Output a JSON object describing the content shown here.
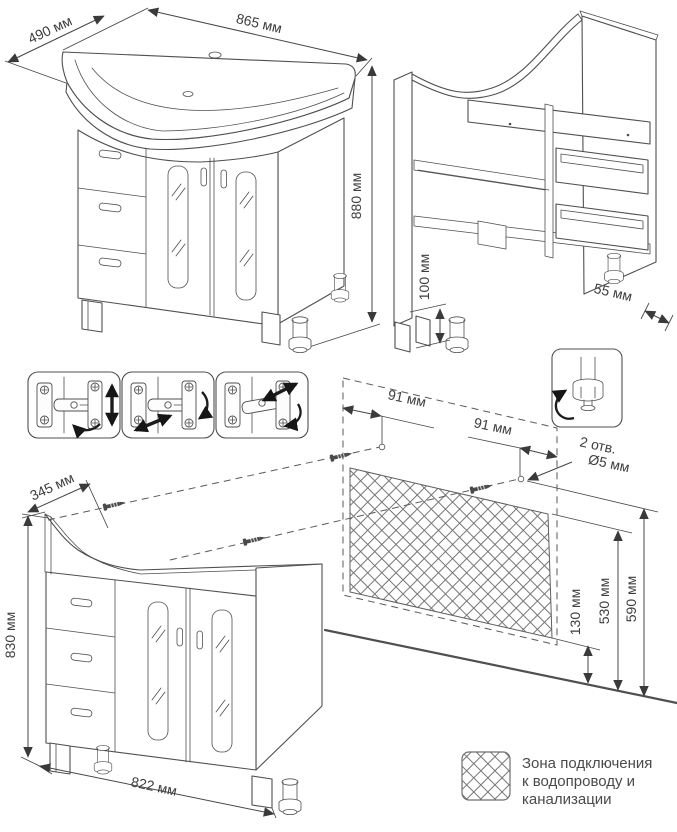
{
  "labels": {
    "assembled": {
      "depth": "490 мм",
      "width": "865 мм",
      "height": "880 мм"
    },
    "carcass": {
      "leg_height": "100 мм",
      "back_offset": "55 мм"
    },
    "cabinet": {
      "top_depth": "345 мм",
      "height": "830 мм",
      "width": "822 мм"
    },
    "wall_template": {
      "hole_inset_left": "91 мм",
      "hole_inset_right": "91 мм",
      "holes_count": "2 отв.",
      "holes_diameter": "Ø5 мм",
      "zone_bottom": "130 мм",
      "zone_top": "530 мм",
      "holes_height": "590 мм"
    }
  },
  "legend": {
    "line1": "Зона подключения",
    "line2": "к водопроводу и",
    "line3": "канализации"
  },
  "icons": {
    "screw": "mounting-screw",
    "foot": "adjustable-foot-rotation",
    "hinges": [
      "hinge-vertical-adjustment",
      "hinge-depth-adjustment",
      "hinge-lateral-adjustment"
    ],
    "hatch": "connection-zone-hatch"
  },
  "colors": {
    "line": "#4f4f4f",
    "text": "#3d3d3d",
    "hatch": "#767676",
    "arrow": "#3a3a3a",
    "background": "#ffffff"
  }
}
